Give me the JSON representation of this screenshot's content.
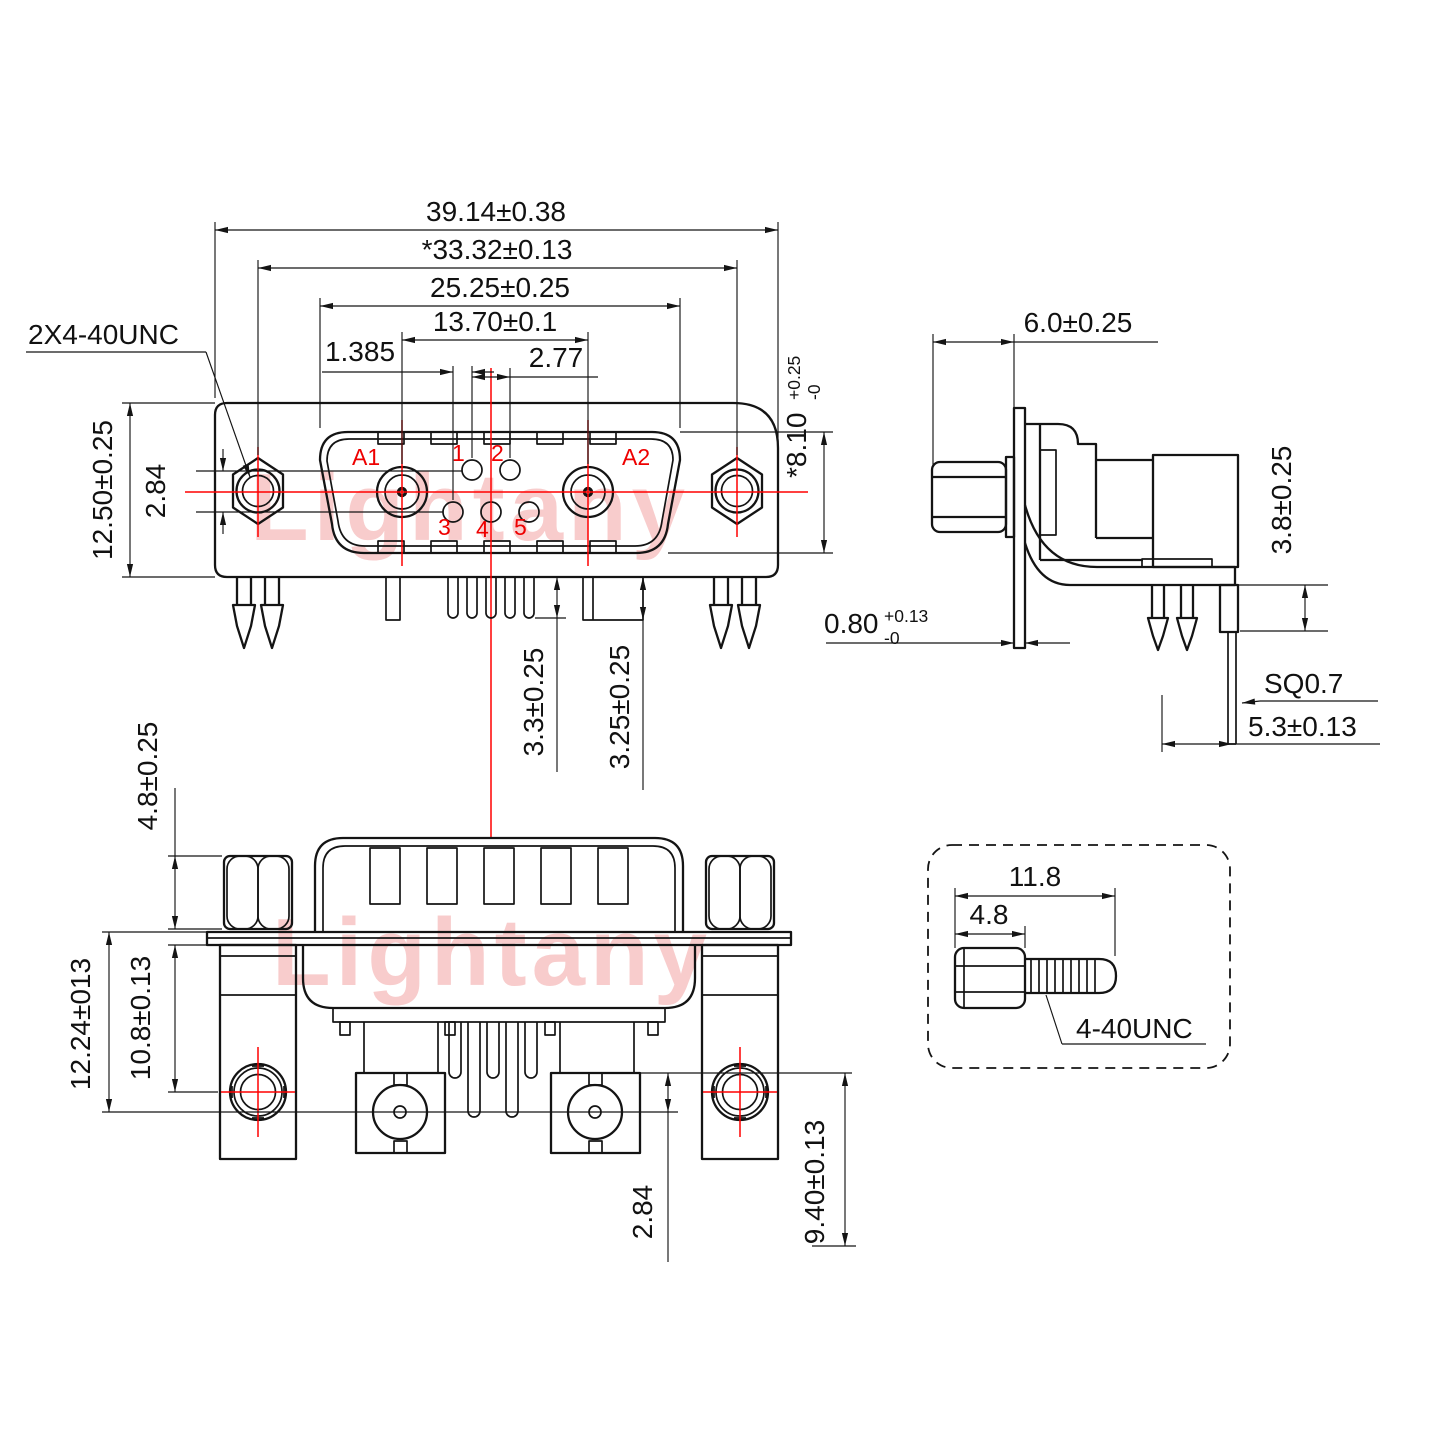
{
  "watermark": {
    "text": "Lightany",
    "color": "#f8cccc"
  },
  "colors": {
    "line": "#141414",
    "centerline": "#ff0000"
  },
  "front_view": {
    "thread_callout": "2X4-40UNC",
    "dim_overall_width": "39.14±0.38",
    "dim_mounting_span": "*33.32±0.13",
    "dim_shell_width": "25.25±0.25",
    "dim_coax_span": "13.70±0.1",
    "dim_pin_pitch": "2.77",
    "dim_pin_offset": "1.385",
    "dim_body_height": "12.50±0.25",
    "dim_pin_row_offset": "2.84",
    "dim_shell_height": "*8.10",
    "dim_shell_height_tol_plus": "+0.25",
    "dim_shell_height_tol_minus": "-0",
    "dim_pin_length": "3.3±0.25",
    "dim_bracket_length": "3.25±0.25",
    "coax_labels": [
      "A1",
      "A2"
    ],
    "pin_labels": [
      "1",
      "2",
      "3",
      "4",
      "5"
    ]
  },
  "side_view": {
    "dim_depth": "6.0±0.25",
    "dim_flange_thickness": "0.80",
    "dim_flange_thickness_tol_plus": "+0.13",
    "dim_flange_thickness_tol_minus": "-0",
    "dim_standoff": "3.8±0.25",
    "pin_square_callout": "SQ0.7",
    "dim_pin_offset": "5.3±0.13"
  },
  "rear_view": {
    "dim_nut_height": "4.8±0.25",
    "dim_mount_span": "12.24±013",
    "dim_inner_span": "10.8±0.13",
    "dim_row_offset": "2.84",
    "dim_coax_depth": "9.40±0.13"
  },
  "detail_view": {
    "dim_total_length": "11.8",
    "dim_head_length": "4.8",
    "thread_callout": "4-40UNC"
  }
}
